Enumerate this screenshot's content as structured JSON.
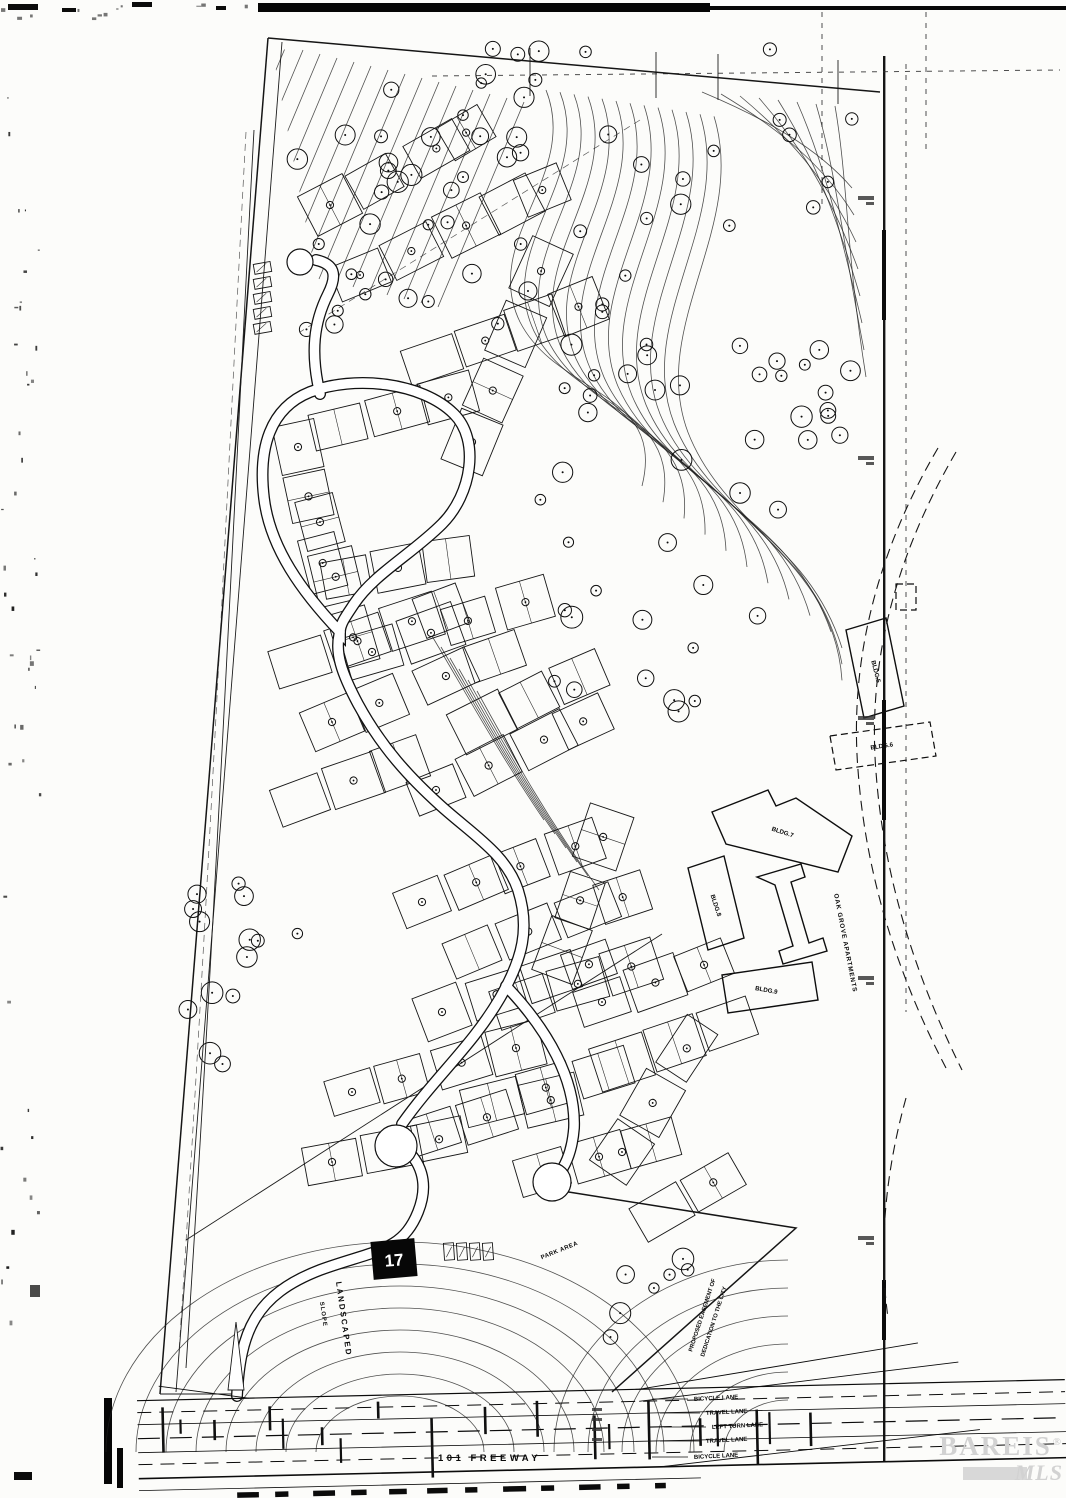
{
  "labels": {
    "freeway": "101 FREEWAY",
    "lanes": [
      "BICYCLE LANE",
      "TRAVEL LANE",
      "LEFT TURN LANE",
      "TRAVEL LANE",
      "BICYCLE LANE"
    ],
    "buildings": {
      "b5": "BLDG.5",
      "b6": "BLDG.6",
      "b7": "BLDG.7",
      "b8": "BLDG.8",
      "b9": "BLDG.9"
    },
    "apartments": "OAK GROVE APARTMENTS",
    "landscaped_1": "LANDSCAPED",
    "landscaped_2": "SLOPE",
    "park_area": "PARK AREA",
    "easement_1": "PROPOSED EASEMENT OF",
    "easement_2": "DEDICATION TO THE CITY",
    "lot_marker": "17"
  },
  "watermark": {
    "brand": "BAREIS",
    "reg": "®",
    "mls": "MLS"
  },
  "colors": {
    "ink": "#1a1a1a",
    "paper": "#fcfcfa",
    "watermark": "#d0d0d0"
  }
}
